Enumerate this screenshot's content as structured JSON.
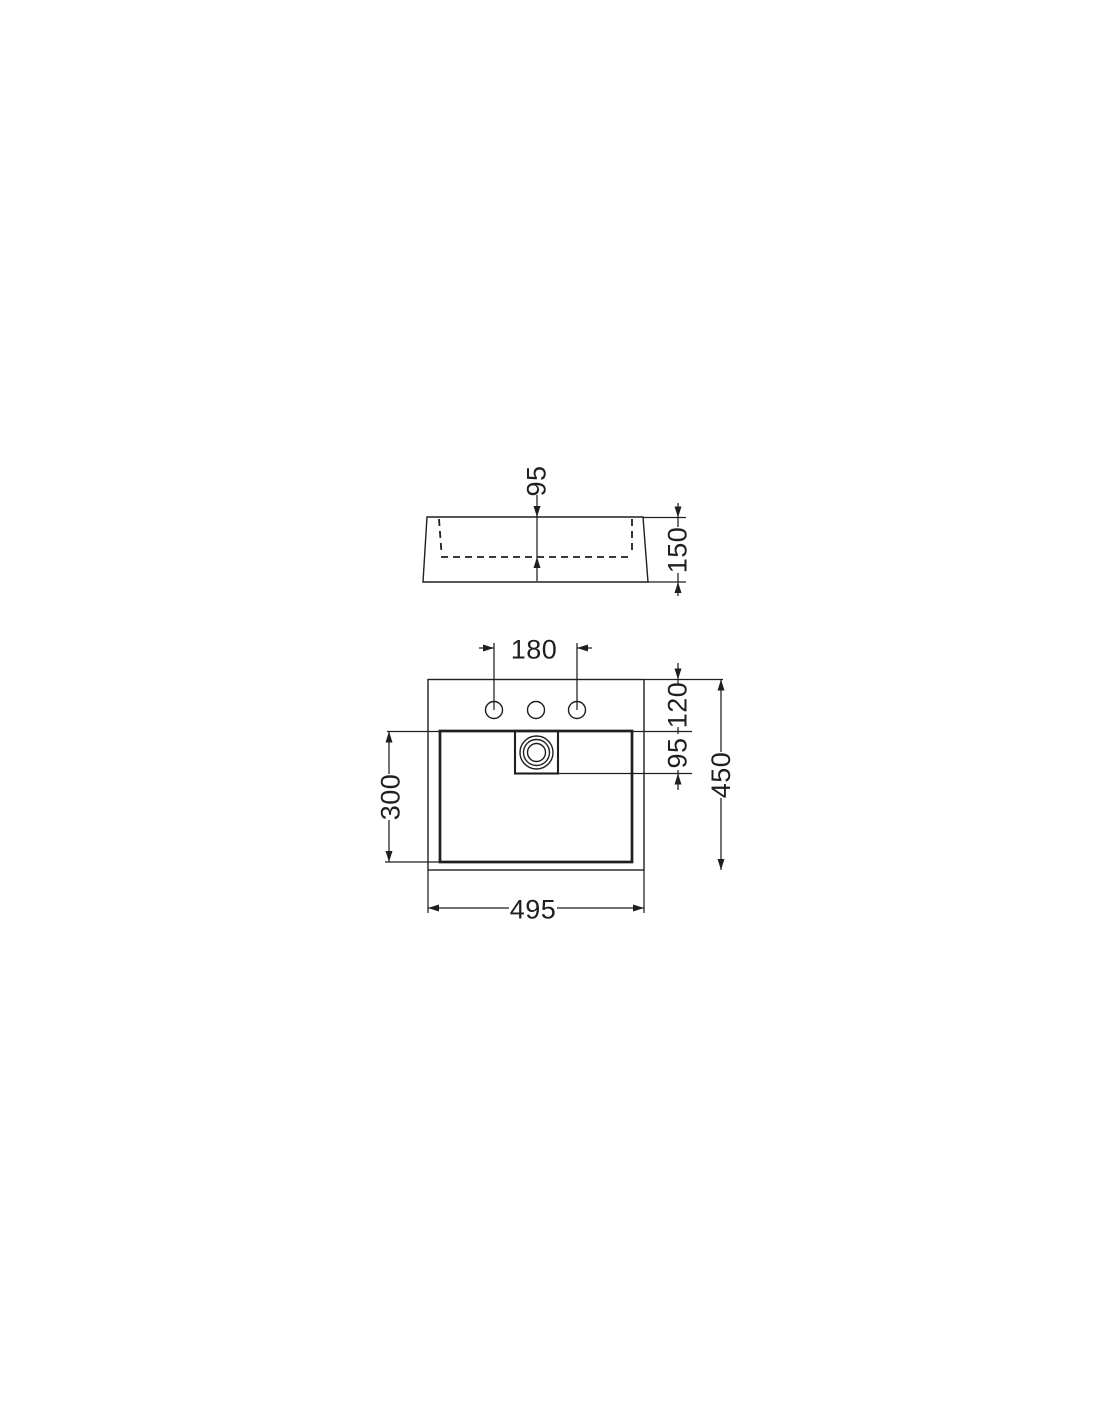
{
  "page": {
    "background": "#ffffff",
    "line_color": "#1f1f1f"
  },
  "drawing": {
    "kind": "washbasin-dimension-drawing",
    "side_view": {
      "dim_basin_inner_depth": "95",
      "dim_overall_height": "150"
    },
    "plan_view": {
      "dim_tap_hole_spacing": "180",
      "dim_front_edge_to_drain_top": "120",
      "dim_drain_recess": "95",
      "dim_overall_depth": "450",
      "dim_basin_length": "300",
      "dim_overall_width": "495"
    }
  }
}
